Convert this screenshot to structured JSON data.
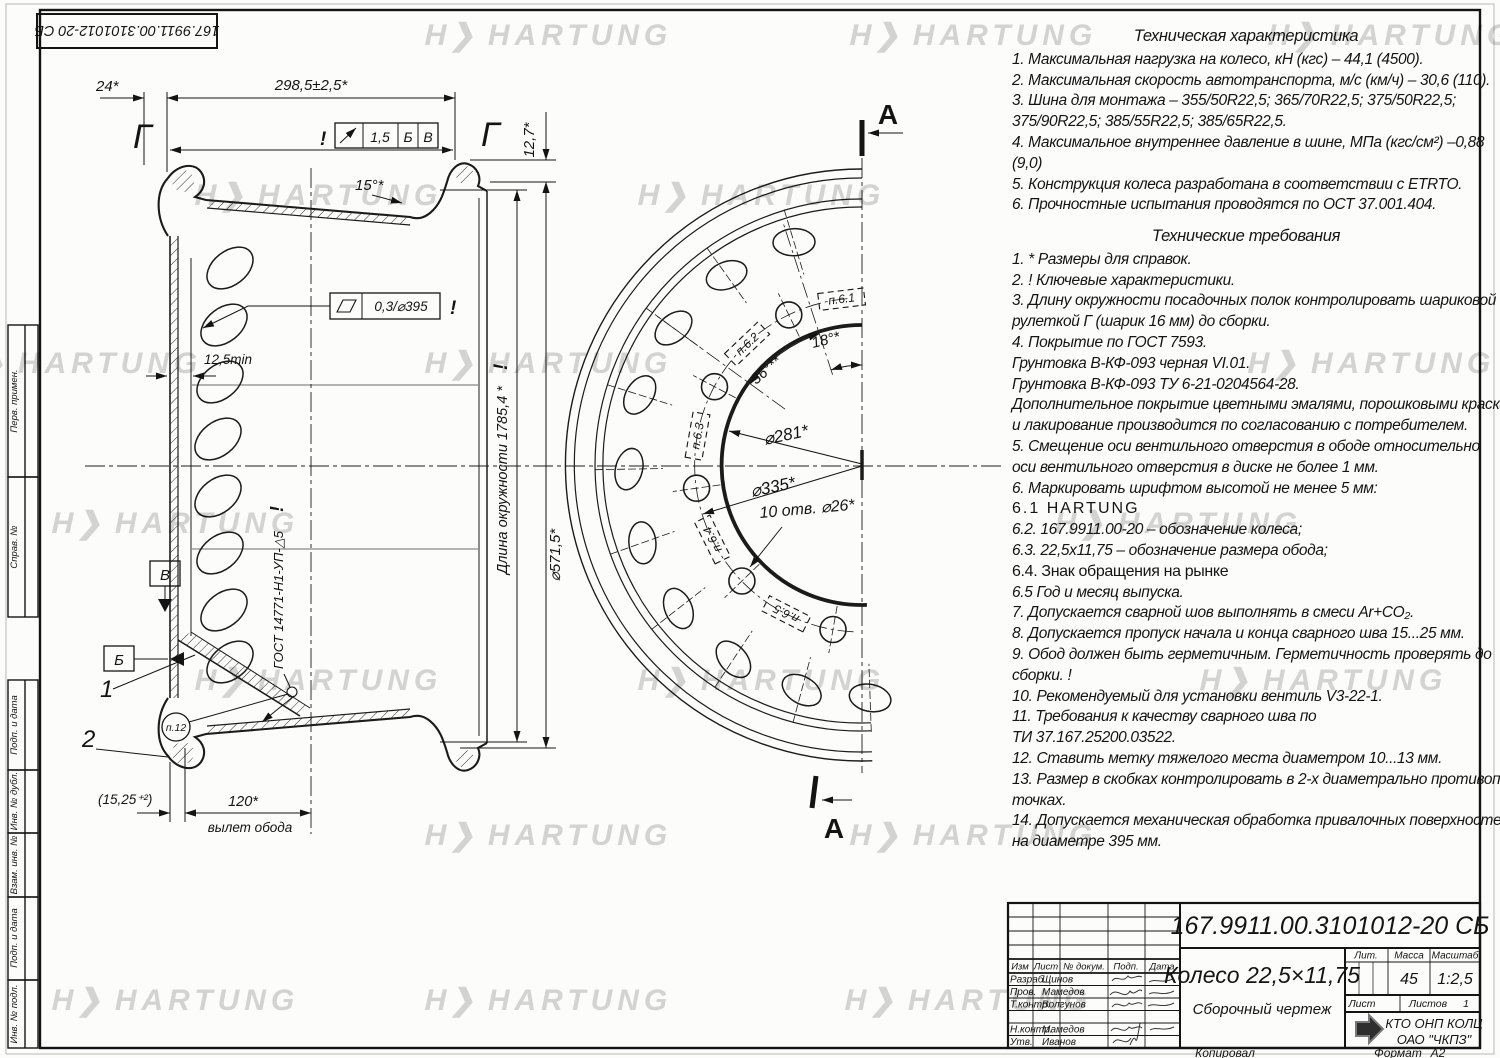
{
  "sheet": {
    "watermark": "HARTUNG",
    "logo_glyph": "H❯",
    "top_stamp": "167.9911.00.3101012-20 СБ",
    "side_labels": [
      "Перв. примен.",
      "Справ. №",
      "Подп. и дата",
      "Инв. № дубл.",
      "Взам. инв. №",
      "Подп. и дата",
      "Инв. № подл."
    ],
    "footer": {
      "copied": "Копировал",
      "format": "Формат",
      "format_value": "А2"
    }
  },
  "left_view": {
    "dim_24": "24*",
    "dim_width": "298,5±2,5*",
    "view_label_left": "Г",
    "view_label_right": "Г",
    "runout": {
      "excl": "!",
      "value": "1,5",
      "d1": "Б",
      "d2": "В"
    },
    "angle_15": "15°*",
    "dim_12_7": "12,7*",
    "flatness_value": "0,3/⌀395",
    "flatness_excl": "!",
    "dim_12_5": "12,5min",
    "circumference": "Длина окружности 1785,4 *",
    "circ_excl": "!",
    "dim_d571": "⌀571,5*",
    "datum_b": "Б",
    "datum_v": "В",
    "pos_1": "1",
    "pos_2": "2",
    "balloon": "п.12",
    "weld": "ГОСТ 14771-Н1-УП-△5",
    "weld_excl": "!",
    "dim_15_25": "(15,25⁺²)",
    "dim_120": "120*",
    "offset_label": "вылет обода"
  },
  "front_view": {
    "section_label": "А",
    "angle_18": "18°*",
    "angle_36": "36°**",
    "dim_d281": "⌀281*",
    "dim_d335": "⌀335*",
    "holes": "10 отв. ⌀26*",
    "marks": [
      "п.6.1",
      "п.6.2",
      "п.6.3",
      "п.6.4",
      "п.6.5"
    ]
  },
  "tech_char": {
    "title": "Техническая характеристика",
    "lines": [
      "1.  Максимальная нагрузка на колесо, кН (кгс) – 44,1 (4500).",
      "2.  Максимальная скорость автотранспорта, м/с (км/ч) – 30,6 (110).",
      "3.  Шина для монтажа – 355/50R22,5;  365/70R22,5;  375/50R22,5;",
      "375/90R22,5;  385/55R22,5;  385/65R22,5.",
      "4.  Максимальное внутреннее давление в шине, МПа (кгс/см²) –0,88",
      "(9,0)",
      "5.  Конструкция колеса разработана в соответствии с ETRTO.",
      "6.  Прочностные испытания проводятся по ОСТ 37.001.404."
    ]
  },
  "tech_req": {
    "title": "Технические требования",
    "lines": [
      "1.  * Размеры для справок.",
      "2.  ! Ключевые характеристики.",
      "3.  Длину окружности посадочных полок контролировать шариковой",
      "рулеткой Г (шарик 16 мм) до сборки.",
      "4.  Покрытие по ГОСТ 7593.",
      "Грунтовка В-КФ-093  черная VI.01.",
      "Грунтовка В-КФ-093 ТУ 6-21-0204564-28.",
      "Дополнительное покрытие цветными эмалями, порошковыми красками",
      "и лакирование производится по согласованию с потребителем.",
      "5.  Смещение оси вентильного отверстия в ободе относительно",
      "оси вентильного отверстия в диске не более 1 мм.",
      "6.  Маркировать шрифтом высотой не менее 5 мм:",
      "6.1  HARTUNG",
      "6.2.  167.9911.00-20 – обозначение колеса;",
      "6.3.  22,5х11,75 –  обозначение размера обода;",
      "6.4.  Знак обращения на рынке",
      "6.5  Год и месяц выпуска.",
      "7.  Допускается сварной шов выполнять в смеси Ar+CO₂.",
      "8.  Допускается пропуск начала и конца сварного шва 15...25 мм.",
      "9.  Обод должен быть герметичным. Герметичность проверять до",
      "сборки.  !",
      "10.  Рекомендуемый для установки вентиль V3-22-1.",
      "11.  Требования к качеству сварного шва по",
      "ТИ 37.167.25200.03522.",
      "12.  Ставить метку тяжелого места диаметром 10...13 мм.",
      "13.  Размер в скобках контролировать в 2-х диаметрально противоположных",
      "точках.",
      "14.  Допускается механическая обработка привалочных поверхностей",
      "на диаметре 395 мм."
    ]
  },
  "title_block": {
    "doc_number": "167.9911.00.3101012-20 СБ",
    "name": "Колесо 22,5×11,75",
    "doc_type": "Сборочный чертеж",
    "lit_label": "Лит.",
    "mass_label": "Масса",
    "scale_label": "Масштаб",
    "mass": "45",
    "scale": "1:2,5",
    "sheet_label": "Лист",
    "sheets_label": "Листов",
    "sheets": "1",
    "company": "КТО ОНП КОЛЦ",
    "company2": "ОАО \"ЧКПЗ\"",
    "header": {
      "izm": "Изм",
      "list": "Лист",
      "doc": "№ докум.",
      "sign": "Подп.",
      "date": "Дата"
    },
    "rows": [
      {
        "role": "Разраб.",
        "name": "Щинов"
      },
      {
        "role": "Пров.",
        "name": "Мамедов"
      },
      {
        "role": "Т.контр.",
        "name": "Волгунов"
      },
      {
        "role": "",
        "name": ""
      },
      {
        "role": "Н.контр.",
        "name": "Мамедов"
      },
      {
        "role": "Утв.",
        "name": "Иванов"
      }
    ]
  }
}
